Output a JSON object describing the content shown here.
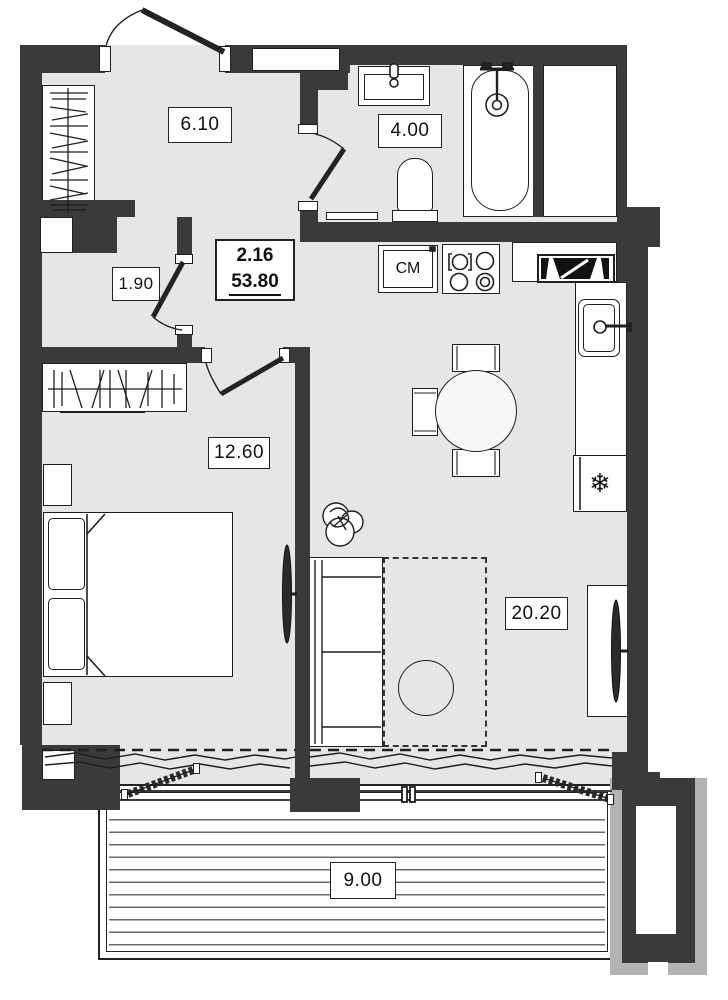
{
  "plan": {
    "apartment": {
      "number": "2.16",
      "total_area": "53.80"
    },
    "rooms": {
      "hall": {
        "area": "6.10"
      },
      "bathroom": {
        "area": "4.00"
      },
      "closet": {
        "area": "1.90"
      },
      "bedroom": {
        "area": "12.60"
      },
      "living": {
        "area": "20.20"
      },
      "balcony": {
        "area": "9.00"
      }
    },
    "appliances": {
      "washing_machine": "СМ",
      "fridge_icon": "❄"
    },
    "colors": {
      "wall": "#3a3a3a",
      "floor": "#e6e6e6",
      "line": "#1f1f1f",
      "metal": "#b3b3b3"
    }
  }
}
